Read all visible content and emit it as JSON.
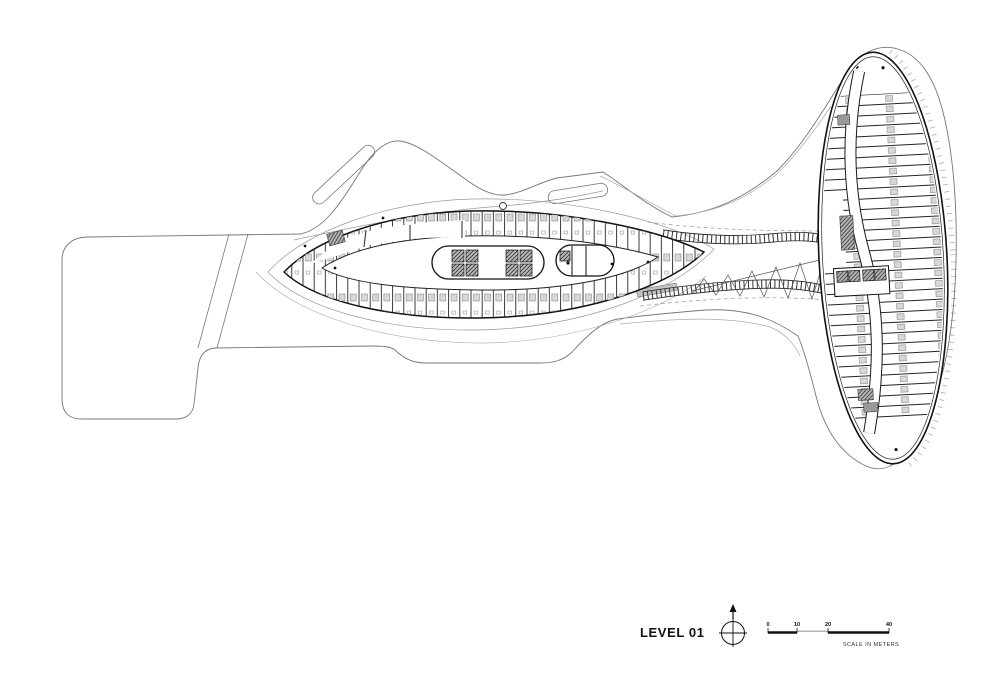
{
  "footer": {
    "title": "LEVEL 01",
    "scale_bar": {
      "ticks": [
        "0",
        "10",
        "20",
        "40"
      ],
      "caption": "SCALE IN METERS"
    }
  },
  "drawing": {
    "type": "architectural floor plan",
    "ink_color": "#1a1a1a",
    "outline_color": "#777777",
    "fixture_fill": "#d8d8d8",
    "background": "#ffffff"
  }
}
